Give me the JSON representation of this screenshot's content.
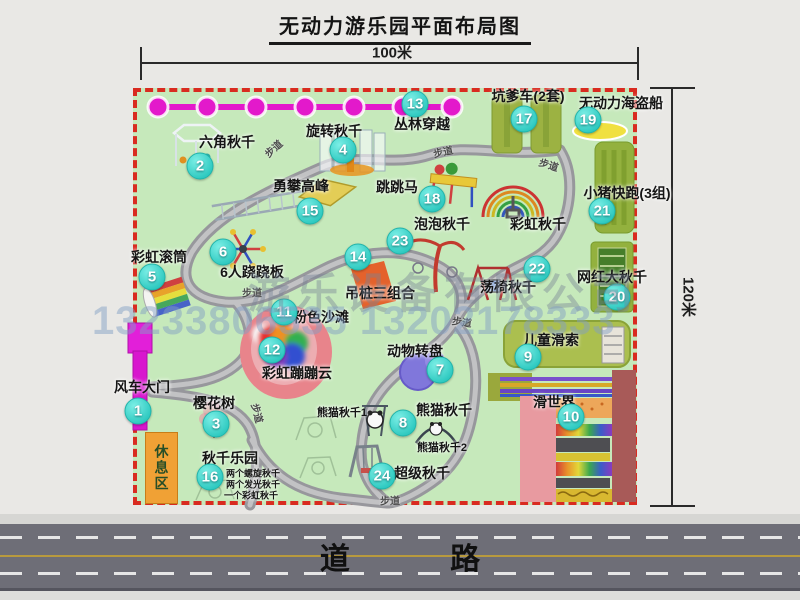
{
  "title": "无动力游乐园平面布局图",
  "dimensions": {
    "width_label": "100米",
    "height_label": "120米"
  },
  "watermark": {
    "line1": "游乐设备有限公司",
    "line2": "13233806535 13202178333"
  },
  "road": {
    "label": "道 路"
  },
  "rest_area_label": "休息区",
  "walkway_label": "步道",
  "colors": {
    "map_green": "#c6e9bb",
    "border_red": "#d92b20",
    "zipline_magenta": "#e319cb",
    "badge_cyan": "#2ec9c0",
    "road_gray": "#6e6e77",
    "rest_orange": "#f0a135"
  },
  "attractions": {
    "a1": {
      "num": "1",
      "label": "风车大门"
    },
    "a2": {
      "num": "2",
      "label": "六角秋千"
    },
    "a3": {
      "num": "3",
      "label": "樱花树"
    },
    "a4": {
      "num": "4",
      "label": "旋转秋千"
    },
    "a5": {
      "num": "5",
      "label": "彩虹滚筒"
    },
    "a6": {
      "num": "6",
      "label": "6人跷跷板"
    },
    "a7": {
      "num": "7",
      "label": "动物转盘"
    },
    "a8": {
      "num": "8",
      "label": "熊猫秋千",
      "sub1": "熊猫秋千1",
      "sub2": "熊猫秋千2"
    },
    "a9": {
      "num": "9",
      "label": "儿童滑索"
    },
    "a10": {
      "num": "10",
      "label": "滑世界"
    },
    "a11": {
      "num": "11",
      "label": "粉色沙滩"
    },
    "a12": {
      "num": "12",
      "label": "彩虹蹦蹦云"
    },
    "a13": {
      "num": "13",
      "label": "丛林穿越"
    },
    "a14": {
      "num": "14",
      "label": "吊桩三组合"
    },
    "a15": {
      "num": "15",
      "label": "勇攀高峰"
    },
    "a16": {
      "num": "16",
      "label": "秋千乐园",
      "note1": "两个螺旋秋千",
      "note2": "两个发光秋千",
      "note3": "一个彩虹秋千"
    },
    "a17": {
      "num": "17",
      "label": "坑爹车(2套)"
    },
    "a18": {
      "num": "18",
      "label": "跳跳马"
    },
    "a19": {
      "num": "19",
      "label": "无动力海盗船"
    },
    "a20": {
      "num": "20",
      "label": "网红大秋千"
    },
    "a21": {
      "num": "21",
      "label": "小猪快跑(3组)"
    },
    "a22": {
      "num": "22",
      "label": "荡椅秋千"
    },
    "a23": {
      "num": "23",
      "label": "泡泡秋千"
    },
    "a24": {
      "num": "24",
      "label": "超级秋千"
    },
    "rainbow_swing": {
      "label": "彩虹秋千"
    }
  }
}
